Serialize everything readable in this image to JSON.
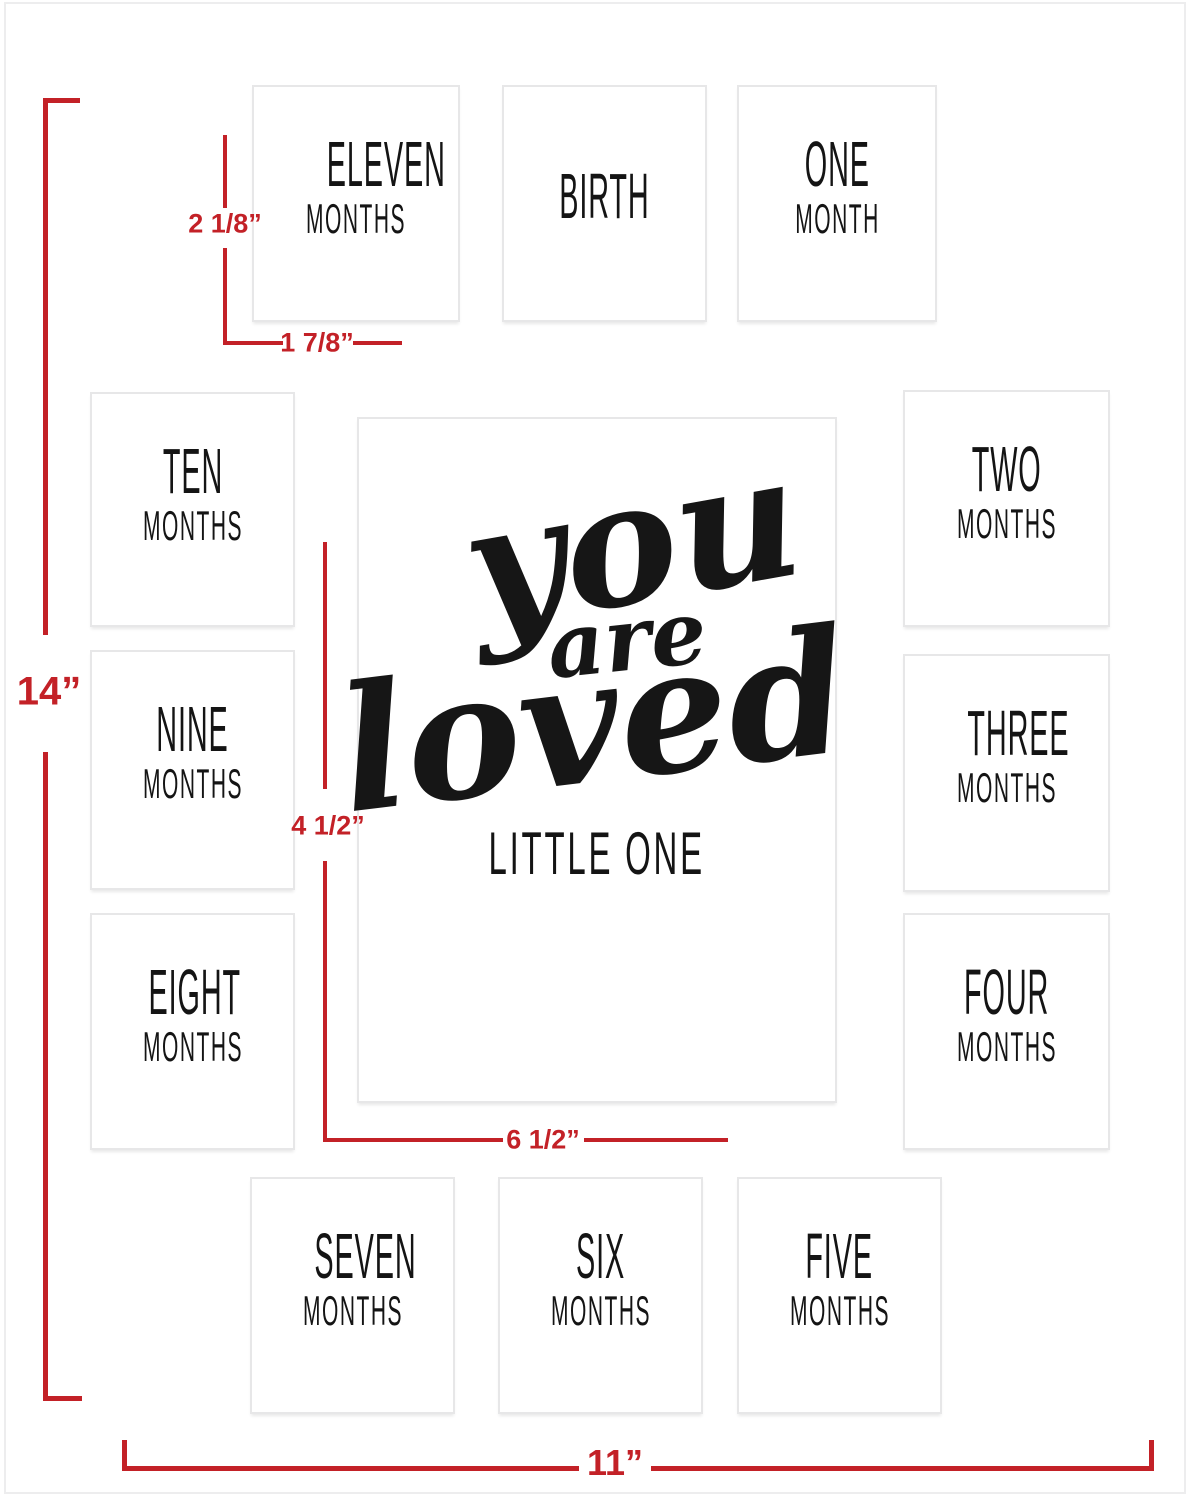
{
  "colors": {
    "dimension_red": "#c32127",
    "text_black": "#141414",
    "opening_border": "#e7e7e8",
    "mat_background": "#ffffff"
  },
  "openings": [
    {
      "id": "eleven-months",
      "line1": "ELEVEN",
      "line2": "MONTHS"
    },
    {
      "id": "birth",
      "line1": "BIRTH",
      "line2": ""
    },
    {
      "id": "one-month",
      "line1": "ONE",
      "line2": "MONTH"
    },
    {
      "id": "ten-months",
      "line1": "TEN",
      "line2": "MONTHS"
    },
    {
      "id": "two-months",
      "line1": "TWO",
      "line2": "MONTHS"
    },
    {
      "id": "nine-months",
      "line1": "NINE",
      "line2": "MONTHS"
    },
    {
      "id": "three-months",
      "line1": "THREE",
      "line2": "MONTHS"
    },
    {
      "id": "eight-months",
      "line1": "EIGHT",
      "line2": "MONTHS"
    },
    {
      "id": "four-months",
      "line1": "FOUR",
      "line2": "MONTHS"
    },
    {
      "id": "seven-months",
      "line1": "SEVEN",
      "line2": "MONTHS"
    },
    {
      "id": "six-months",
      "line1": "SIX",
      "line2": "MONTHS"
    },
    {
      "id": "five-months",
      "line1": "FIVE",
      "line2": "MONTHS"
    }
  ],
  "center": {
    "script_line1": "you",
    "script_line2": "are",
    "script_line3": "loved",
    "subtitle": "LITTLE ONE"
  },
  "annotations": [
    {
      "name": "mat-height",
      "value": "14”"
    },
    {
      "name": "small-opening-height",
      "value": "2 1/8”"
    },
    {
      "name": "small-opening-width",
      "value": "1 7/8”"
    },
    {
      "name": "center-opening-vertical",
      "value": "4 1/2”"
    },
    {
      "name": "center-opening-horizontal",
      "value": "6 1/2”"
    },
    {
      "name": "mat-width",
      "value": "11”"
    }
  ]
}
